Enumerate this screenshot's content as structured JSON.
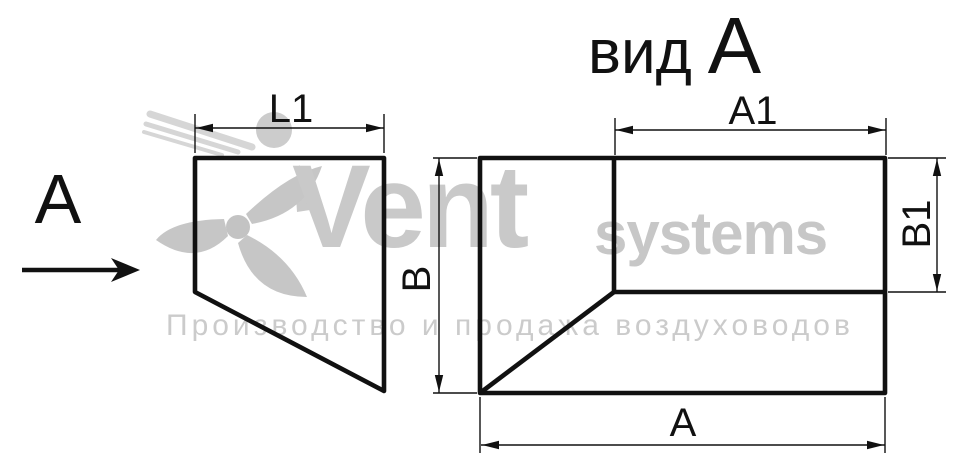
{
  "drawing": {
    "type": "duct-transition-technical-drawing",
    "side_view": {
      "view_label": "A",
      "dim_l1": "L1"
    },
    "view_a": {
      "title_word": "вид",
      "title_letter": "А",
      "dim_a1": "A1",
      "dim_b1": "B1",
      "dim_b": "B",
      "dim_a": "A"
    }
  },
  "watermark": {
    "brand": "Vent",
    "brand_suffix": "systems",
    "tagline": "Производство и продажа воздуховодов"
  },
  "colors": {
    "background": "#ffffff",
    "line": "#111111",
    "watermark_text": "#c9c9c9",
    "watermark_logo": "#c6c6c6"
  }
}
